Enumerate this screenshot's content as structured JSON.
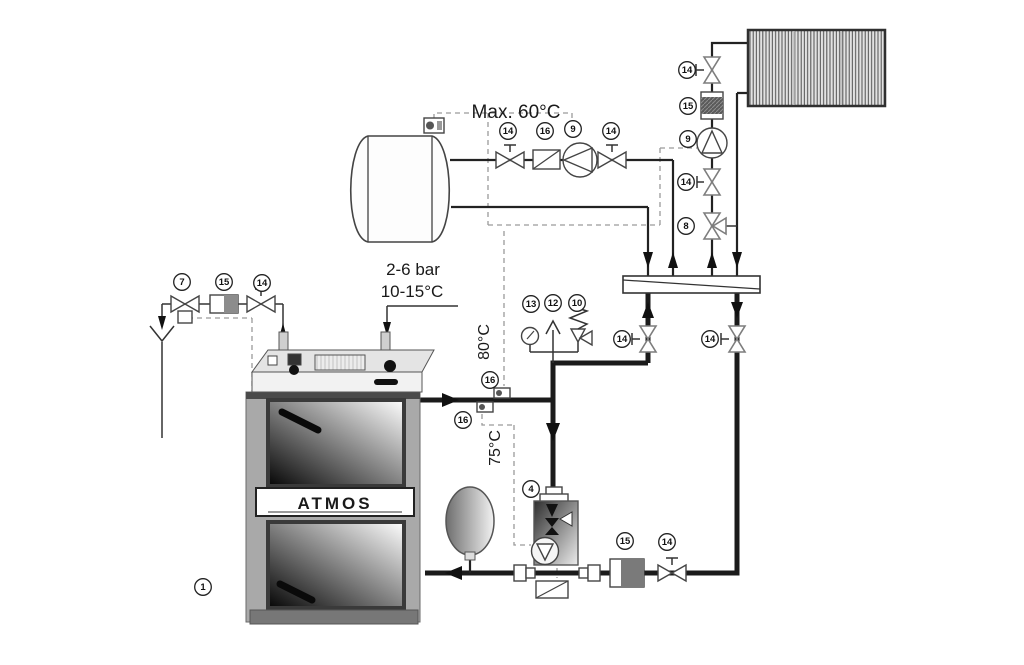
{
  "diagram": {
    "type": "heating-system-piping-schematic",
    "texts": {
      "max_temp": "Max. 60°C",
      "pressure_range": "2-6 bar",
      "cold_water_temp": "10-15°C",
      "supply_temp": "80°C",
      "return_temp": "75°C",
      "boiler_brand": "ATMOS"
    },
    "labels": [
      {
        "id": "dhw-valve-left",
        "text": "14"
      },
      {
        "id": "dhw-check-valve",
        "text": "16"
      },
      {
        "id": "dhw-pump",
        "text": "9"
      },
      {
        "id": "dhw-valve-right",
        "text": "14"
      },
      {
        "id": "radiator-valve-top",
        "text": "14"
      },
      {
        "id": "radiator-filter",
        "text": "15"
      },
      {
        "id": "radiator-pump",
        "text": "9"
      },
      {
        "id": "radiator-valve-mid",
        "text": "14"
      },
      {
        "id": "mixing-valve",
        "text": "8"
      },
      {
        "id": "pressure-gauge",
        "text": "13"
      },
      {
        "id": "air-vent",
        "text": "12"
      },
      {
        "id": "safety-valve",
        "text": "10"
      },
      {
        "id": "supply-sensor",
        "text": "16"
      },
      {
        "id": "return-sensor",
        "text": "16"
      },
      {
        "id": "separator-valve-supply",
        "text": "14"
      },
      {
        "id": "separator-valve-return",
        "text": "14"
      },
      {
        "id": "cooling-valve",
        "text": "7"
      },
      {
        "id": "cooling-filter",
        "text": "15"
      },
      {
        "id": "cooling-shutoff",
        "text": "14"
      },
      {
        "id": "laddomat",
        "text": "4"
      },
      {
        "id": "return-filter",
        "text": "15"
      },
      {
        "id": "return-valve",
        "text": "14"
      },
      {
        "id": "boiler",
        "text": "1"
      }
    ]
  }
}
